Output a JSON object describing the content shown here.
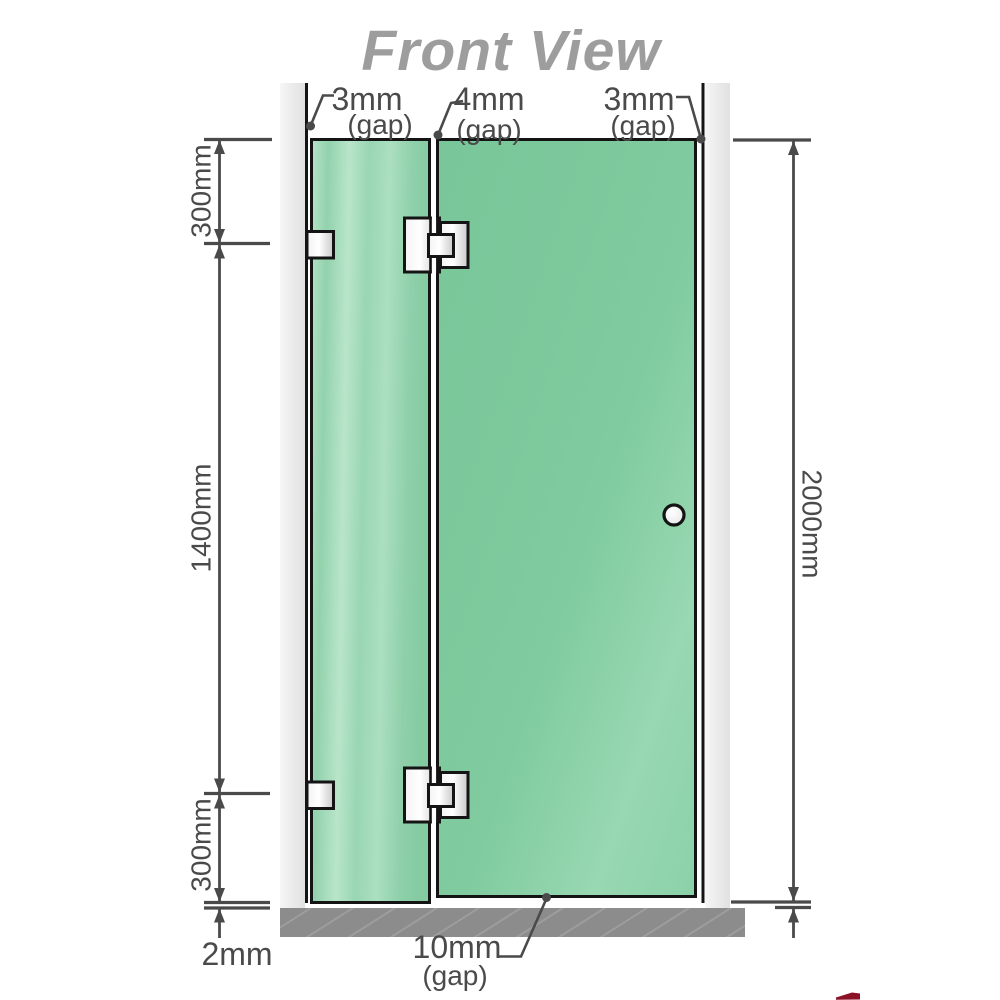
{
  "title": "Front View",
  "top_gap_labels": {
    "left": {
      "value": "3mm",
      "note": "(gap)"
    },
    "middle": {
      "value": "4mm",
      "note": "(gap)"
    },
    "right": {
      "value": "3mm",
      "note": "(gap)"
    }
  },
  "bottom_gap_label": {
    "value": "10mm",
    "note": "(gap)"
  },
  "left_dimensions": {
    "top": "300mm",
    "middle": "1400mm",
    "bottom": "300mm",
    "floor_gap": "2mm"
  },
  "right_dimension": {
    "total_height": "2000mm"
  },
  "colors": {
    "glass_fixed_panel": "#9bd5b3",
    "glass_door": "#7fcb9f",
    "wall": "#ebebeb",
    "floor": "#8c8c8c",
    "outline": "#141414",
    "dimension_gray": "#4a4a4a",
    "title_gray": "#9d9d9d",
    "logo_fragment_red": "#8c1127"
  }
}
